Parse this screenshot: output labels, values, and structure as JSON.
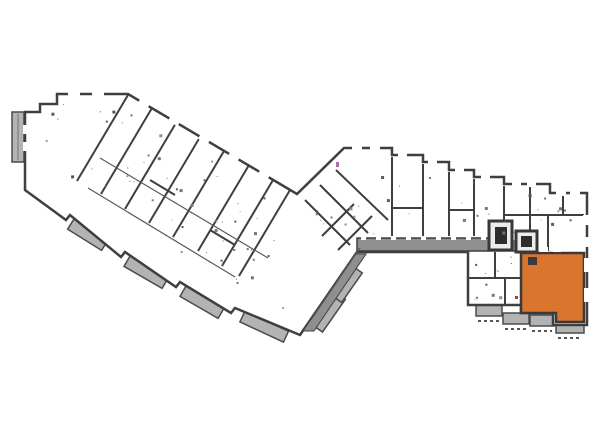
{
  "app": {
    "name": "residential-floor-plan-viewer"
  },
  "floor_plan": {
    "background": "#ffffff",
    "wall_color": "#3f3f3f",
    "interior_color": "#ffffff",
    "balcony_fill": "#b3b3b3",
    "corridor_fill": "#8f8f8f",
    "core_fill": "#ececec",
    "core_inner_fill": "#2d2d2d",
    "detail_green": "#6e7b55",
    "detail_magenta": "#b06ab0",
    "detail_red": "#b33b2b",
    "highlighted_unit": {
      "name": "selected-unit",
      "fill": "#d9752c",
      "state": "highlighted"
    }
  }
}
